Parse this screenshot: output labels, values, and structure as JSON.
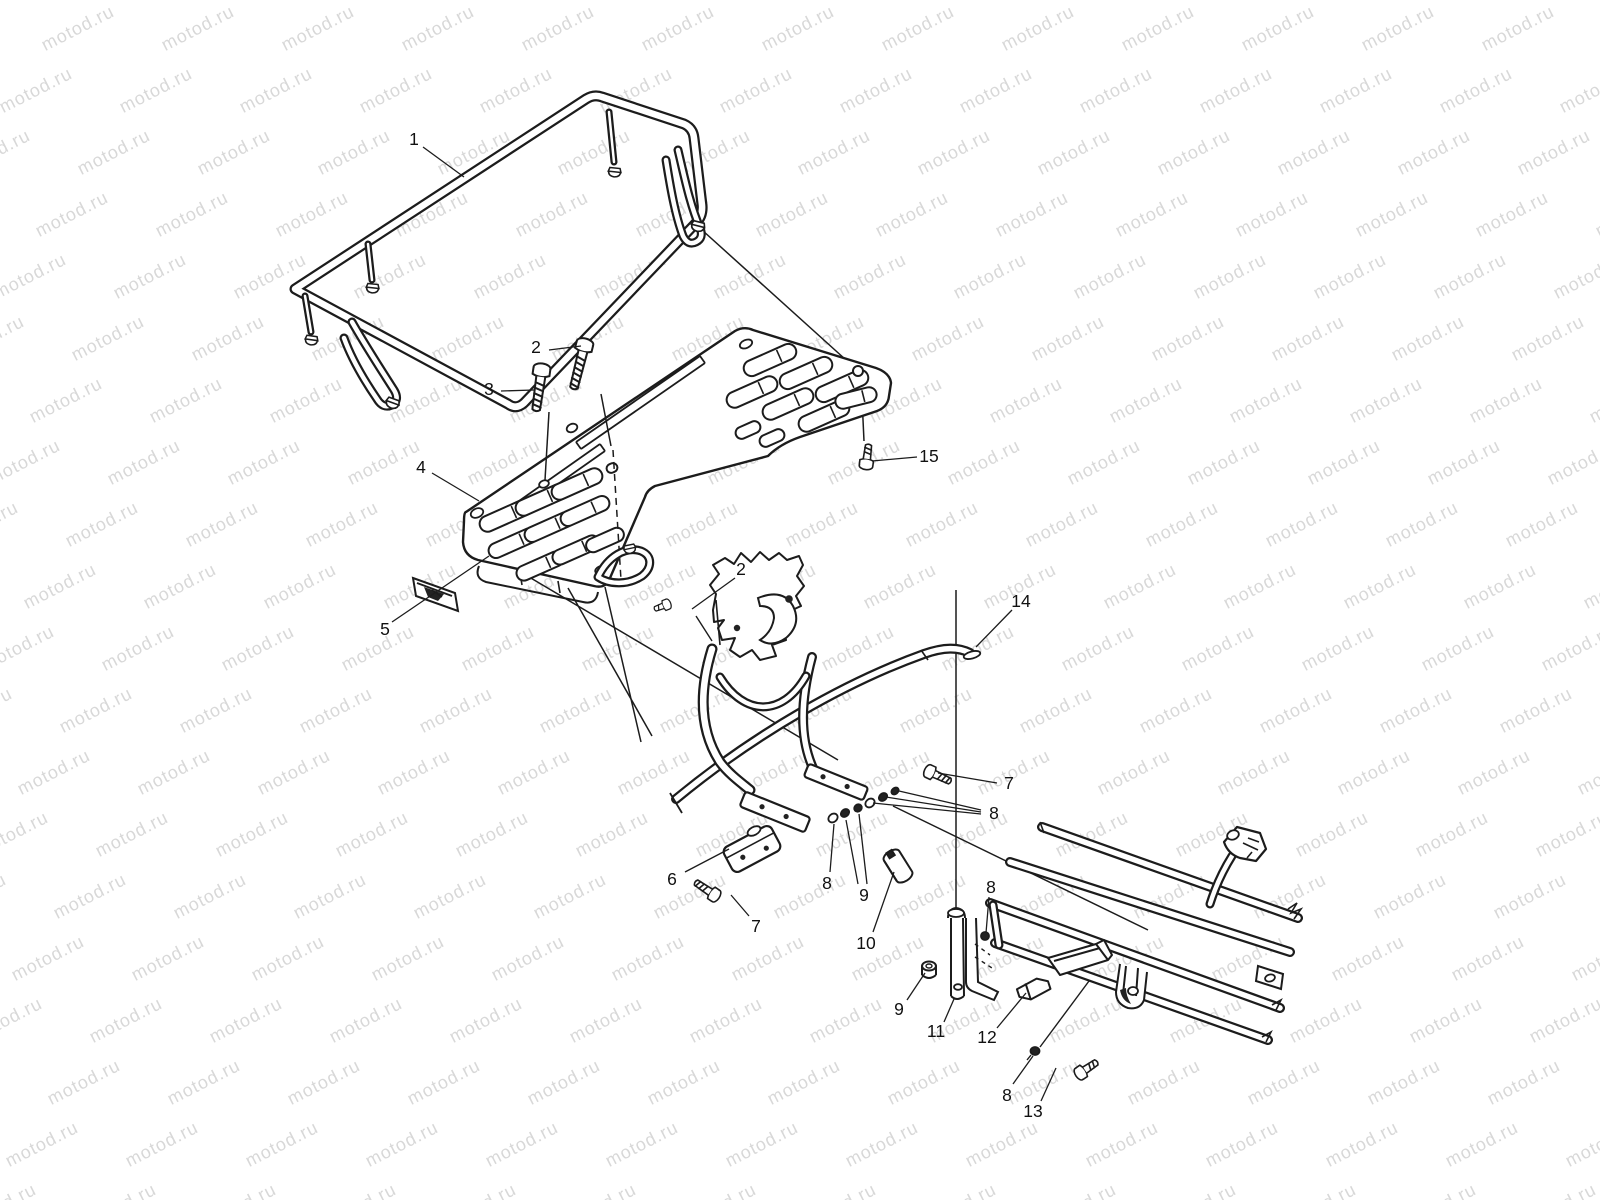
{
  "page": {
    "background": "#ffffff",
    "line_color": "#1c1c1c"
  },
  "watermark": {
    "text": "motod.ru",
    "color": "#d8d8d8"
  },
  "callouts": [
    {
      "label": "1"
    },
    {
      "label": "2"
    },
    {
      "label": "3"
    },
    {
      "label": "4"
    },
    {
      "label": "5"
    },
    {
      "label": "2"
    },
    {
      "label": "14"
    },
    {
      "label": "7"
    },
    {
      "label": "8"
    },
    {
      "label": "6"
    },
    {
      "label": "8"
    },
    {
      "label": "9"
    },
    {
      "label": "10"
    },
    {
      "label": "7"
    },
    {
      "label": "8"
    },
    {
      "label": "9"
    },
    {
      "label": "11"
    },
    {
      "label": "12"
    },
    {
      "label": "8"
    },
    {
      "label": "13"
    },
    {
      "label": "15"
    }
  ]
}
